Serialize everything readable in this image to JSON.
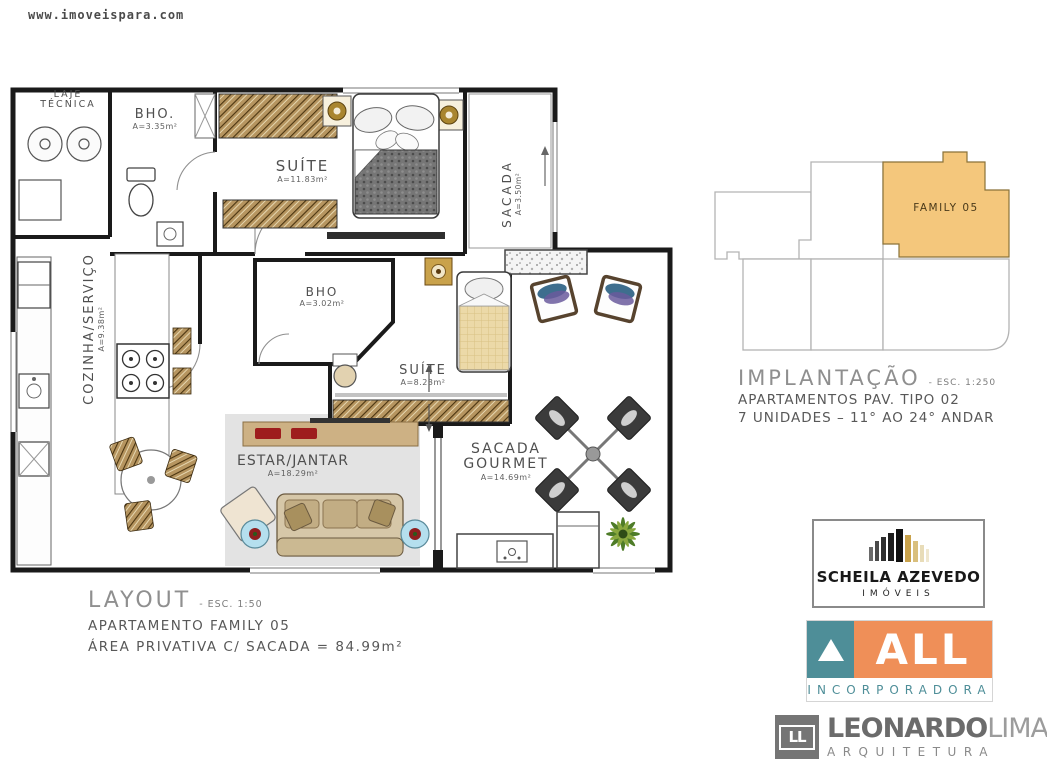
{
  "page": {
    "watermark": "www.imoveispara.com",
    "background": "#ffffff"
  },
  "floor_plan": {
    "rooms": [
      {
        "id": "laje-tecnica",
        "line1": "LAJE",
        "line2": "TÉCNICA",
        "area": ""
      },
      {
        "id": "bho-1",
        "line1": "BHO.",
        "area": "A=3.35m²"
      },
      {
        "id": "suite-1",
        "line1": "SUÍTE",
        "area": "A=11.83m²"
      },
      {
        "id": "sacada",
        "line1": "SACADA",
        "area": "A=3.50m²"
      },
      {
        "id": "cozinha-servico",
        "line1": "COZINHA/SERVIÇO",
        "area": "A=9.38m²"
      },
      {
        "id": "bho-2",
        "line1": "BHO",
        "area": "A=3.02m²"
      },
      {
        "id": "suite-2",
        "line1": "SUÍTE",
        "area": "A=8.23m²"
      },
      {
        "id": "estar-jantar",
        "line1": "ESTAR/JANTAR",
        "area": "A=18.29m²"
      },
      {
        "id": "sacada-gourmet",
        "line1": "SACADA",
        "line2": "GOURMET",
        "area": "A=14.69m²"
      }
    ],
    "caption": {
      "title": "LAYOUT",
      "scale": "- ESC. 1:50",
      "line1": "APARTAMENTO FAMILY 05",
      "line2": "ÁREA PRIVATIVA C/ SACADA = 84.99m²"
    }
  },
  "implantation": {
    "unit_label": "FAMILY 05",
    "highlight_color": "#f4c77c",
    "caption": {
      "title": "IMPLANTAÇÃO",
      "scale": "- ESC. 1:250",
      "line1": "APARTAMENTOS PAV. TIPO 02",
      "line2": "7 UNIDADES – 11° AO 24° ANDAR"
    }
  },
  "logos": {
    "scheila": {
      "name": "SCHEILA AZEVEDO",
      "subtitle": "IMÓVEIS",
      "gold": "#c9a24b",
      "dark": "#1e1e1e"
    },
    "all": {
      "name": "ALL",
      "subtitle": "INCORPORADORA",
      "teal": "#4e8e98",
      "orange": "#ef8f58"
    },
    "leonardo": {
      "monogram": "LL",
      "name_bold": "LEONARDO",
      "name_light": "LIMA",
      "subtitle": "ARQUITETURA",
      "gray": "#757575"
    }
  }
}
